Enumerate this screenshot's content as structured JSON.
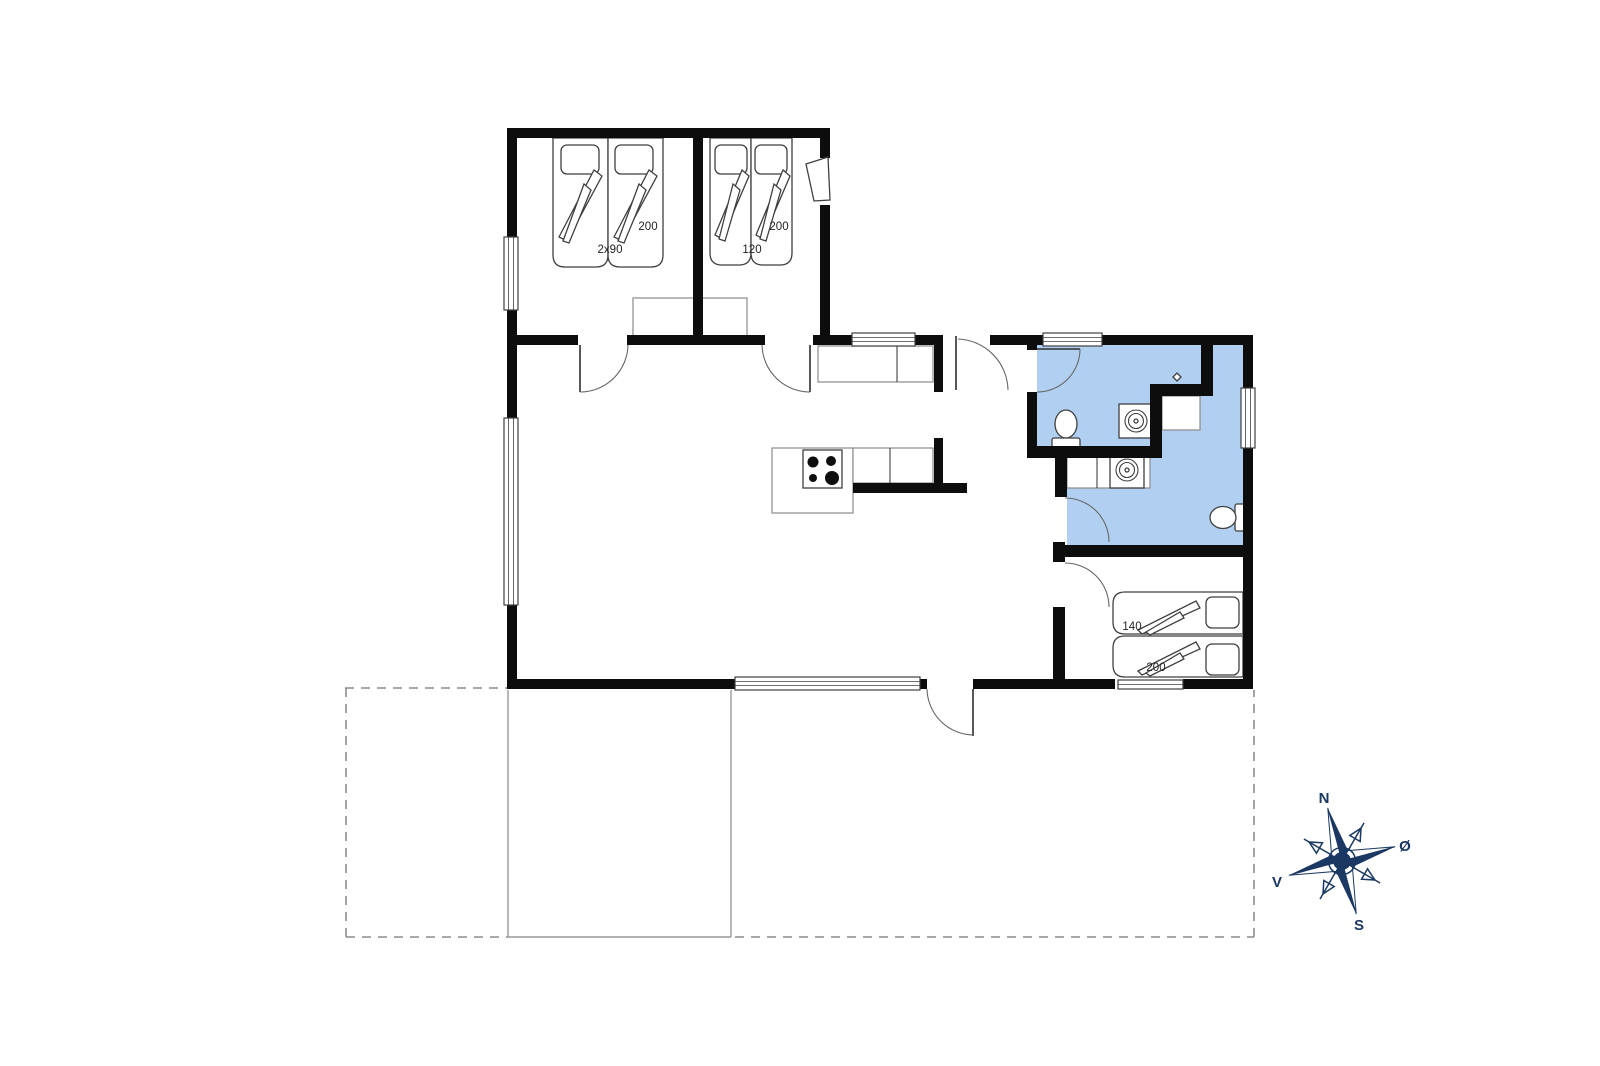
{
  "colors": {
    "wall": "#0d0d0d",
    "room_highlight": "#b1d0f1",
    "compass": "#1a3862",
    "furniture_line": "#8a8a8a",
    "fixture_line": "#3f3f3f",
    "dash_line": "#8c8c8c"
  },
  "plan": {
    "bedroom1": {
      "bed_length": "200",
      "bed_width": "2x90"
    },
    "bedroom2": {
      "bed_length": "200",
      "bed_width": "120"
    },
    "bedroom3": {
      "bed_width": "140",
      "bed_length": "200"
    }
  },
  "compass": {
    "north": "N",
    "east": "Ø",
    "south": "S",
    "west": "V"
  }
}
